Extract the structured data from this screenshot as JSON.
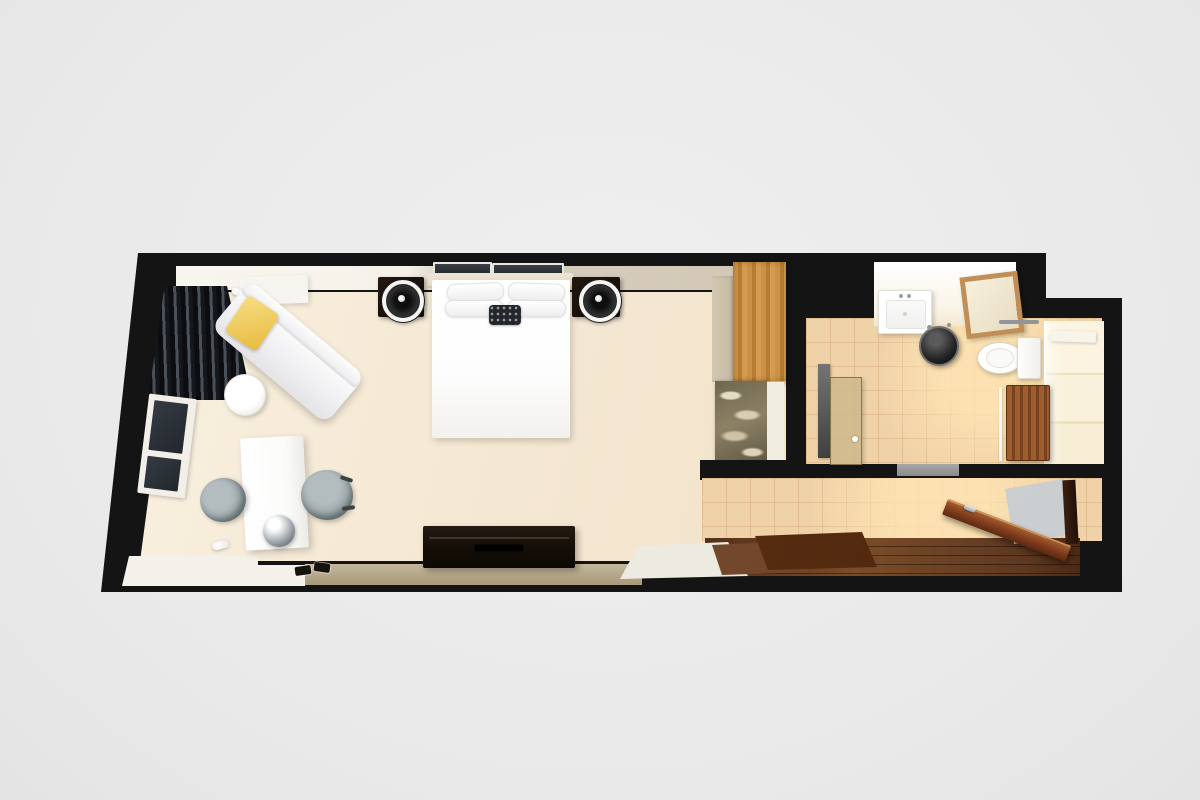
{
  "scene": {
    "type": "3d-floor-plan-render",
    "view": "top-down",
    "subject": "hotel guest room with bathroom and entry corridor",
    "visible_text": "none",
    "background_color": "#ebebeb",
    "wall_color": "#141414"
  },
  "rooms": [
    {
      "id": "bedroom",
      "floor_finish": "cream carpet",
      "floor_color": "#f3e6d0",
      "furniture": [
        {
          "name": "double-bed",
          "color": "#ffffff"
        },
        {
          "name": "headboard",
          "color": "#ece4d1"
        },
        {
          "name": "bed-pillows",
          "count": 4,
          "color": "#ffffff"
        },
        {
          "name": "accent-pillow",
          "color": "#23262c",
          "pattern": "dot-grid"
        },
        {
          "name": "nightstand-left",
          "color": "#1b120a"
        },
        {
          "name": "nightstand-right",
          "color": "#1b120a"
        },
        {
          "name": "table-lamp-left",
          "style": "round drum, white ring"
        },
        {
          "name": "table-lamp-right",
          "style": "round drum, white ring"
        },
        {
          "name": "wall-art-left",
          "color": "#2b2f33"
        },
        {
          "name": "wall-art-right",
          "color": "#2b2f33"
        },
        {
          "name": "chaise-lounge",
          "color": "#f4f4f6",
          "orientation": "diagonal"
        },
        {
          "name": "chaise-pillow",
          "color": "#eec14f"
        },
        {
          "name": "side-table",
          "shape": "round",
          "color": "#fbfaf7"
        },
        {
          "name": "curtains",
          "color": "#14171c",
          "style": "pleated blackout"
        },
        {
          "name": "window",
          "glass_color": "#2a3036",
          "frame_color": "#f2efe8"
        },
        {
          "name": "desk",
          "color": "#fdfdfd"
        },
        {
          "name": "kettle",
          "finish": "chrome"
        },
        {
          "name": "desk-chair-left",
          "color": "#98a3a5"
        },
        {
          "name": "desk-chair-right",
          "color": "#98a3a5"
        },
        {
          "name": "tv-console",
          "color": "#171008"
        },
        {
          "name": "slippers",
          "count": 2,
          "color": "#16130f"
        },
        {
          "name": "wall-sconce-upper",
          "color": "#ffffff"
        },
        {
          "name": "wall-sconce-lower",
          "color": "#ffffff"
        },
        {
          "name": "white-cabinet",
          "color": "#f7f5ef"
        }
      ]
    },
    {
      "id": "closet-minibar-nook",
      "furniture": [
        {
          "name": "wardrobe-door",
          "finish": "oak wood",
          "color": "#c08038"
        },
        {
          "name": "wardrobe-side-panel",
          "color": "#cdc2ae"
        },
        {
          "name": "minibar-marble-counter",
          "finish": "veined marble",
          "color": "#857b61"
        },
        {
          "name": "nook-side-panel",
          "color": "#f2ede1"
        }
      ]
    },
    {
      "id": "bathroom",
      "floor_finish": "beige ceramic tile",
      "floor_color": "#f0d2a8",
      "furniture": [
        {
          "name": "vanity-sink",
          "color": "#ffffff"
        },
        {
          "name": "mirror",
          "frame_color": "#bf8f55"
        },
        {
          "name": "stool",
          "color": "#242424",
          "shape": "round"
        },
        {
          "name": "toilet",
          "color": "#ffffff",
          "tank_side": "right"
        },
        {
          "name": "teak-bench",
          "finish": "teak slats",
          "color": "#8a4f27"
        },
        {
          "name": "shower-wall",
          "color": "#f8eed6"
        },
        {
          "name": "glass-partition",
          "color": "rgba(252,252,252,0.85)"
        },
        {
          "name": "bath-shelf",
          "color": "#f8f4ea"
        },
        {
          "name": "towel-bar",
          "color": "#8f9598"
        },
        {
          "name": "bathroom-door",
          "finish": "frosted glass",
          "color": "#cdb98c"
        },
        {
          "name": "glass-panel-dark",
          "color": "#5a5a5a"
        },
        {
          "name": "shower-sill",
          "color": "#9c9c9c"
        }
      ]
    },
    {
      "id": "entry-corridor",
      "floor_finish": "tile upper / dark wood lower",
      "furniture": [
        {
          "name": "entry-door",
          "state": "open",
          "color": "#7c3a1b",
          "handle": "steel"
        },
        {
          "name": "door-opening",
          "color": "#d2d4d6"
        },
        {
          "name": "door-jamb",
          "color": "#3a2013"
        },
        {
          "name": "floor-mat-light",
          "color": "#7d5233"
        },
        {
          "name": "floor-mat-dark",
          "color": "#5f3315"
        },
        {
          "name": "white-step",
          "color": "#f2efe8"
        },
        {
          "name": "wood-floor",
          "color": "#6a4223"
        }
      ]
    }
  ]
}
